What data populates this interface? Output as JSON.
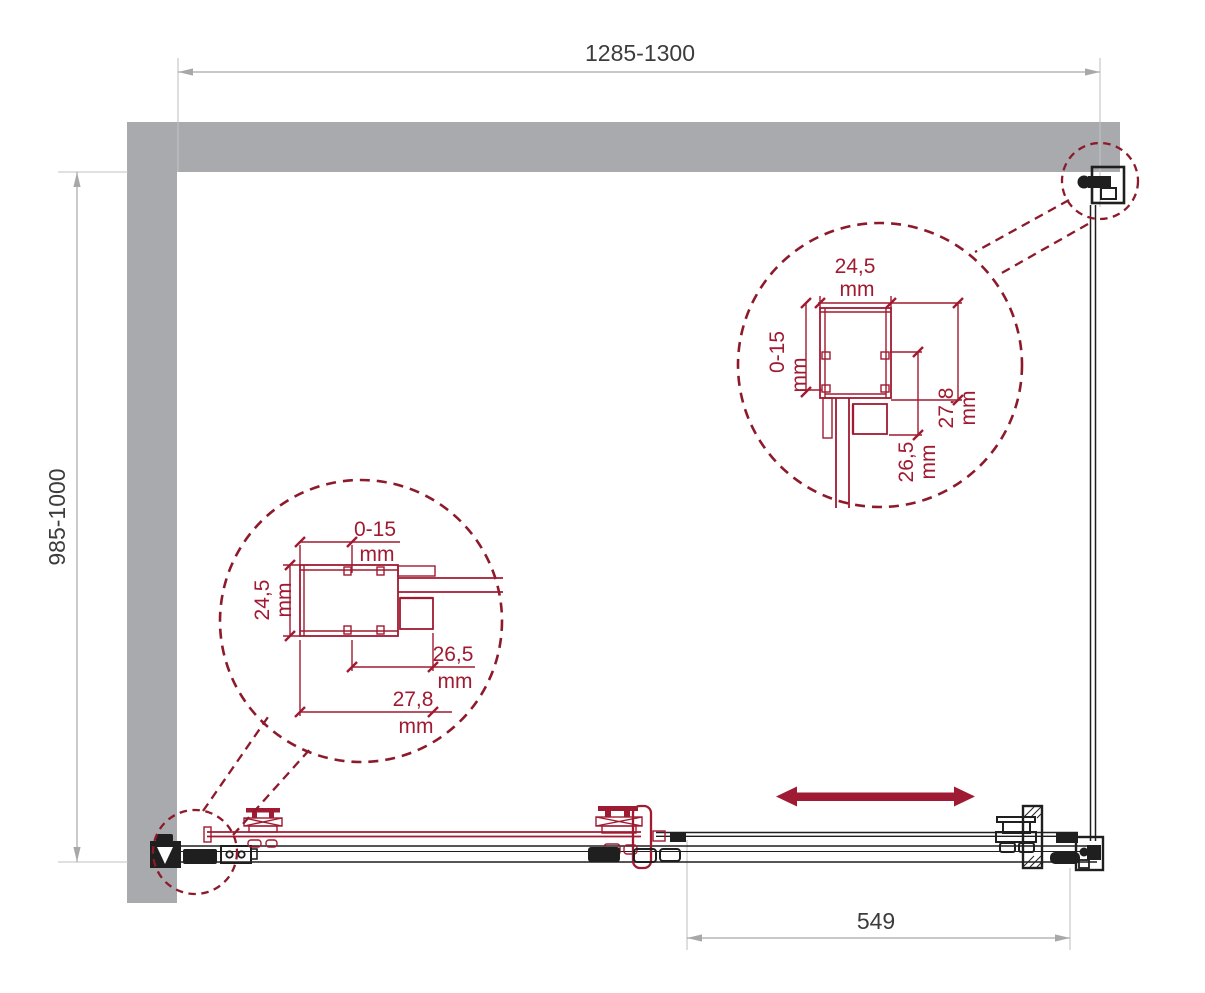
{
  "drawing": {
    "type": "shower-enclosure-plan-technical-drawing",
    "width_dimension": "1285-1300",
    "depth_dimension": "985-1000",
    "door_opening_dimension": "549"
  },
  "detail_left": {
    "top_value": "0-15",
    "top_unit": "mm",
    "side_value": "24,5",
    "side_unit": "mm",
    "inner_value": "26,5",
    "inner_unit": "mm",
    "bottom_value": "27,8",
    "bottom_unit": "mm"
  },
  "detail_right": {
    "top_value": "24,5",
    "top_unit": "mm",
    "side_value": "0-15",
    "side_unit": "mm",
    "outer_value": "27,8",
    "outer_unit": "mm",
    "inner_value": "26,5",
    "inner_unit": "mm"
  },
  "icons": {
    "slide_direction_arrow": "double-headed-horizontal-arrow"
  },
  "colors": {
    "accent_maroon": "#9E1B33",
    "detail_dashed_maroon": "#8C1A2B",
    "wall_gray": "#A9AAAD",
    "dimension_gray": "#A8A8A8",
    "ink_black": "#1F1F1F"
  }
}
